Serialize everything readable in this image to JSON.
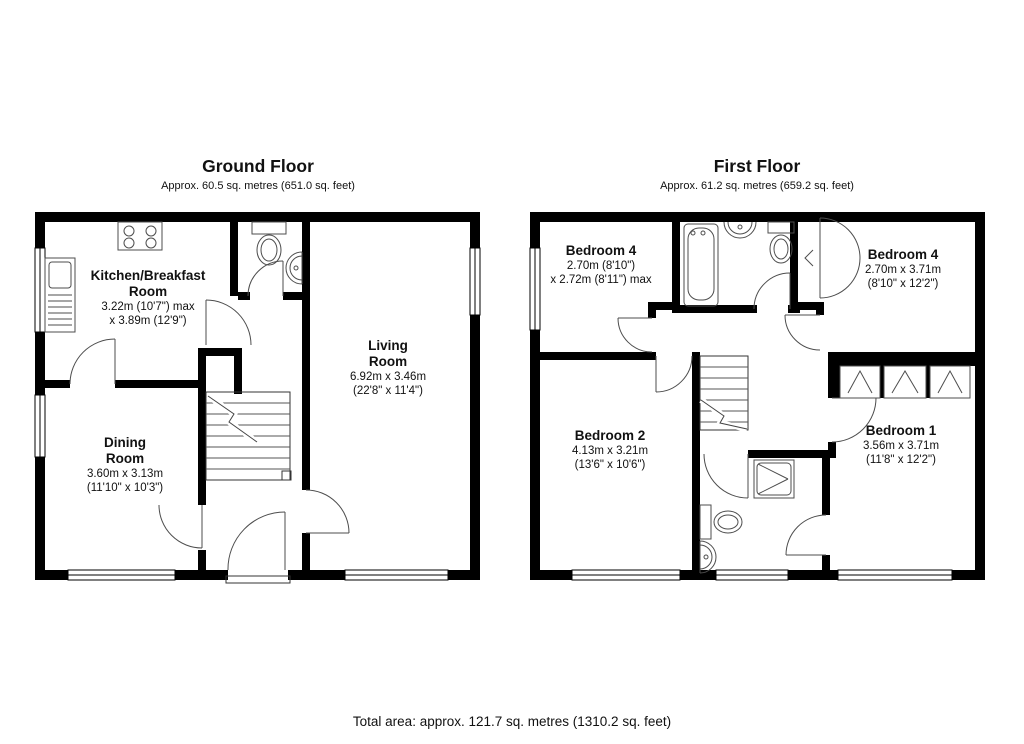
{
  "ground_floor": {
    "title": "Ground Floor",
    "subtitle": "Approx. 60.5 sq. metres (651.0 sq. feet)",
    "rooms": [
      {
        "name1": "Kitchen/Breakfast",
        "name2": "Room",
        "dim1": "3.22m (10'7\") max",
        "dim2": "x 3.89m (12'9\")"
      },
      {
        "name1": "Living",
        "name2": "Room",
        "dim1": "6.92m x 3.46m",
        "dim2": "(22'8\" x 11'4\")"
      },
      {
        "name1": "Dining",
        "name2": "Room",
        "dim1": "3.60m x 3.13m",
        "dim2": "(11'10\" x 10'3\")"
      }
    ]
  },
  "first_floor": {
    "title": "First Floor",
    "subtitle": "Approx. 61.2 sq. metres (659.2 sq. feet)",
    "rooms": [
      {
        "name1": "Bedroom 4",
        "dim1": "2.70m (8'10\")",
        "dim2": "x 2.72m (8'11\") max"
      },
      {
        "name1": "Bedroom 4",
        "dim1": "2.70m x 3.71m",
        "dim2": "(8'10\" x 12'2\")"
      },
      {
        "name1": "Bedroom 2",
        "dim1": "4.13m x 3.21m",
        "dim2": "(13'6\" x 10'6\")"
      },
      {
        "name1": "Bedroom 1",
        "dim1": "3.56m x 3.71m",
        "dim2": "(11'8\" x 12'2\")"
      }
    ]
  },
  "footer": {
    "total_area": "Total area: approx. 121.7 sq. metres (1310.2 sq. feet)"
  },
  "colors": {
    "wall": "#000000",
    "fixture_line": "#4d4d4d",
    "background": "#ffffff"
  }
}
